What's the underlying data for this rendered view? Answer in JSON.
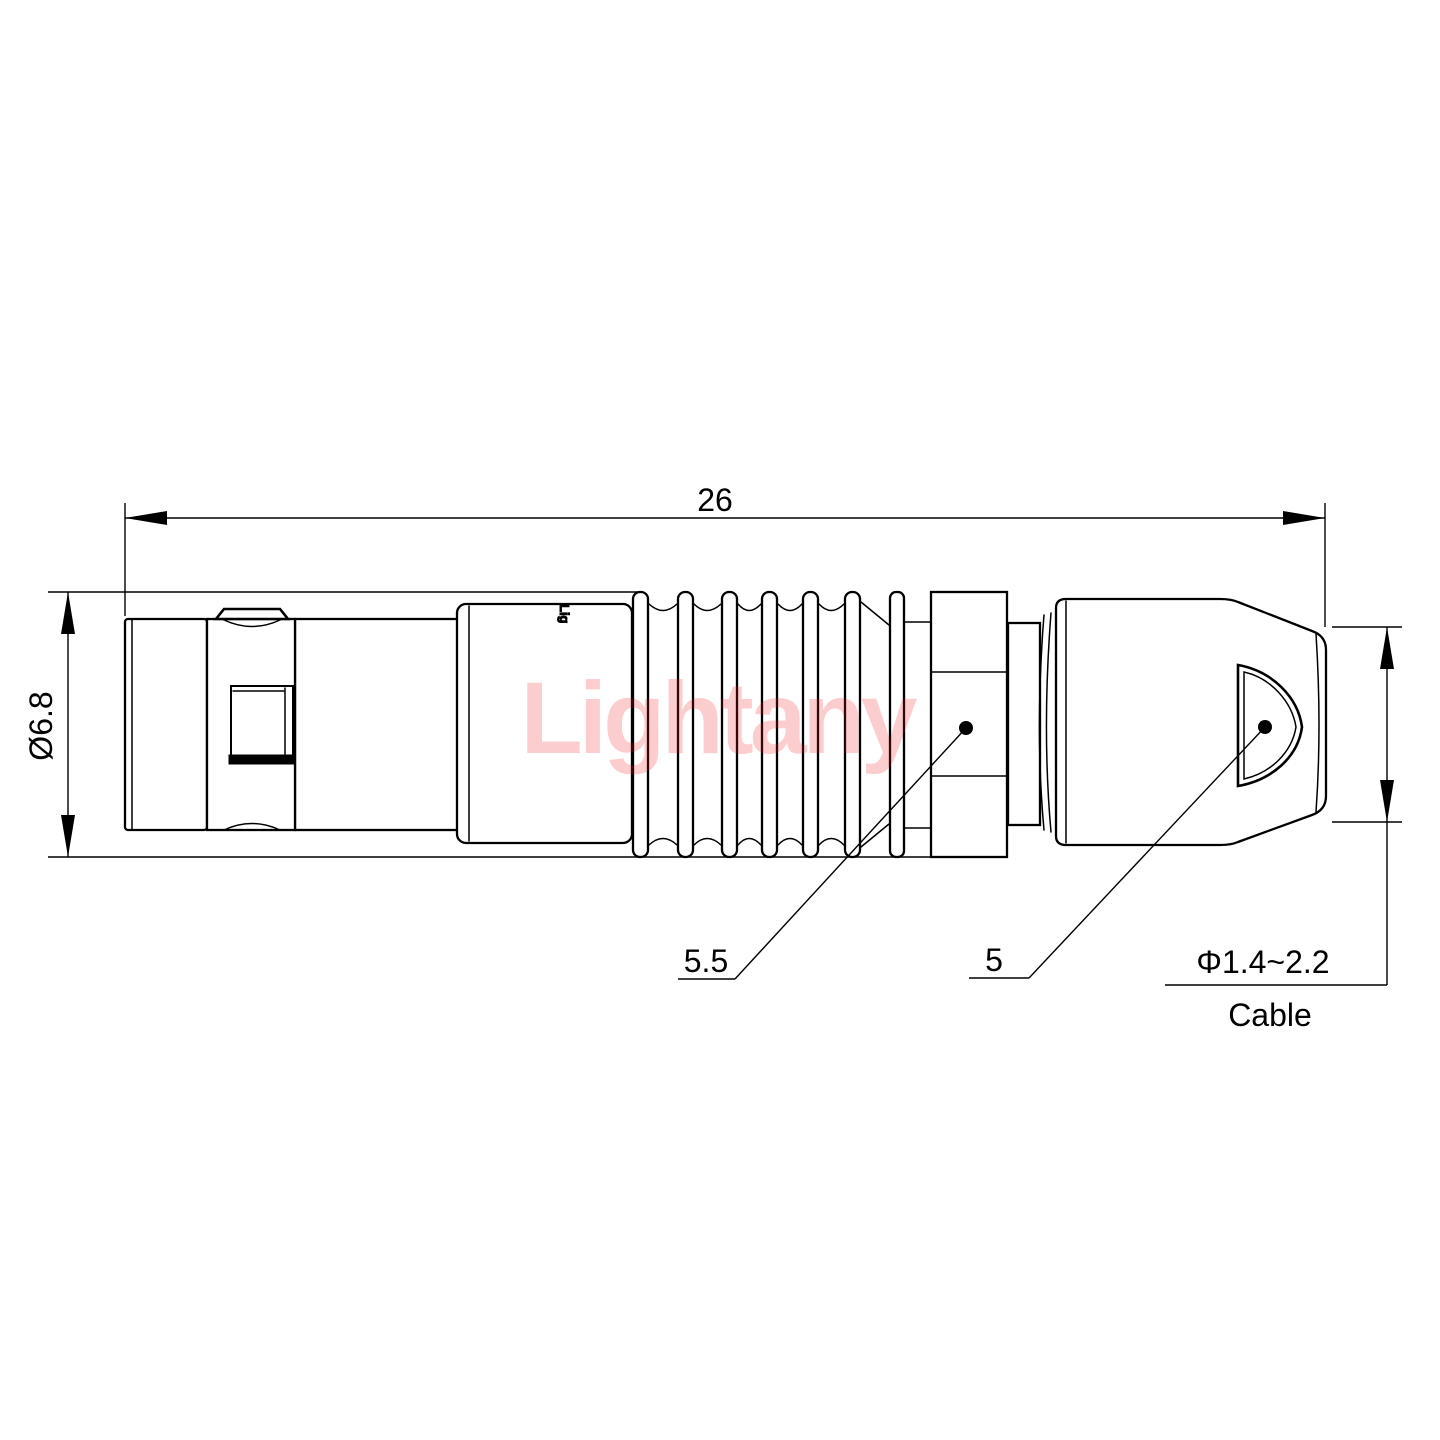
{
  "drawing": {
    "watermark": "Lightany",
    "brand_mark": "Lig",
    "dimensions": {
      "overall_length": "26",
      "diameter": "Ø6.8",
      "nut_width": "5.5",
      "boot_width": "5",
      "cable_range": "Φ1.4~2.2",
      "cable_label": "Cable"
    },
    "colors": {
      "line": "#000000",
      "watermark_pink": "#ed1c24"
    }
  }
}
